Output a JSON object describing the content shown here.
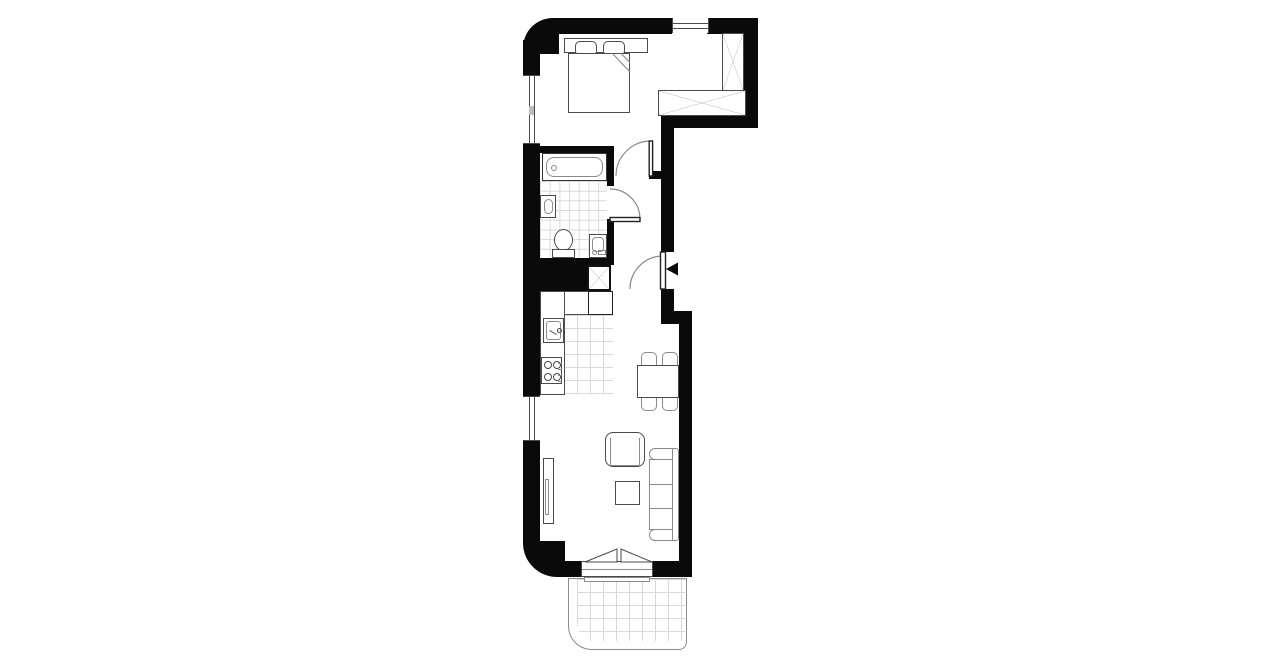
{
  "title": "apartment-floor-plan",
  "colors": {
    "wall": "#0a0a0a",
    "line": "#4a4a4a",
    "line_soft": "#8a8a8a",
    "tile": "#d9d9d9",
    "bg": "#ffffff"
  },
  "plan": {
    "type": "floor-plan",
    "text_labels": [],
    "rooms": [
      {
        "name": "bedroom",
        "fixtures": [
          "double-bed",
          "pillow",
          "pillow",
          "tall-wardrobe-x",
          "wide-wardrobe-x",
          "window-left",
          "window-top"
        ]
      },
      {
        "name": "bathroom",
        "fixtures": [
          "bathtub",
          "washbasin",
          "toilet",
          "washing-machine",
          "floor-tiles",
          "door-swing"
        ]
      },
      {
        "name": "hallway",
        "fixtures": [
          "entrance-door",
          "entrance-triangle-marker",
          "bedroom-door-swing"
        ]
      },
      {
        "name": "kitchen",
        "fixtures": [
          "l-counter",
          "kitchen-sink",
          "stove-4-burners",
          "fridge",
          "duct-shaft-x",
          "floor-tiles",
          "window-left"
        ]
      },
      {
        "name": "living-dining",
        "fixtures": [
          "dining-table",
          "chair",
          "chair",
          "chair",
          "chair",
          "armchair",
          "coffee-table",
          "sofa",
          "tv-unit",
          "balcony-door-triangles"
        ]
      },
      {
        "name": "balcony",
        "fixtures": [
          "tile-grid",
          "rounded-corner"
        ]
      }
    ],
    "entrance_marker": "black triangle pointing left at entrance door"
  }
}
